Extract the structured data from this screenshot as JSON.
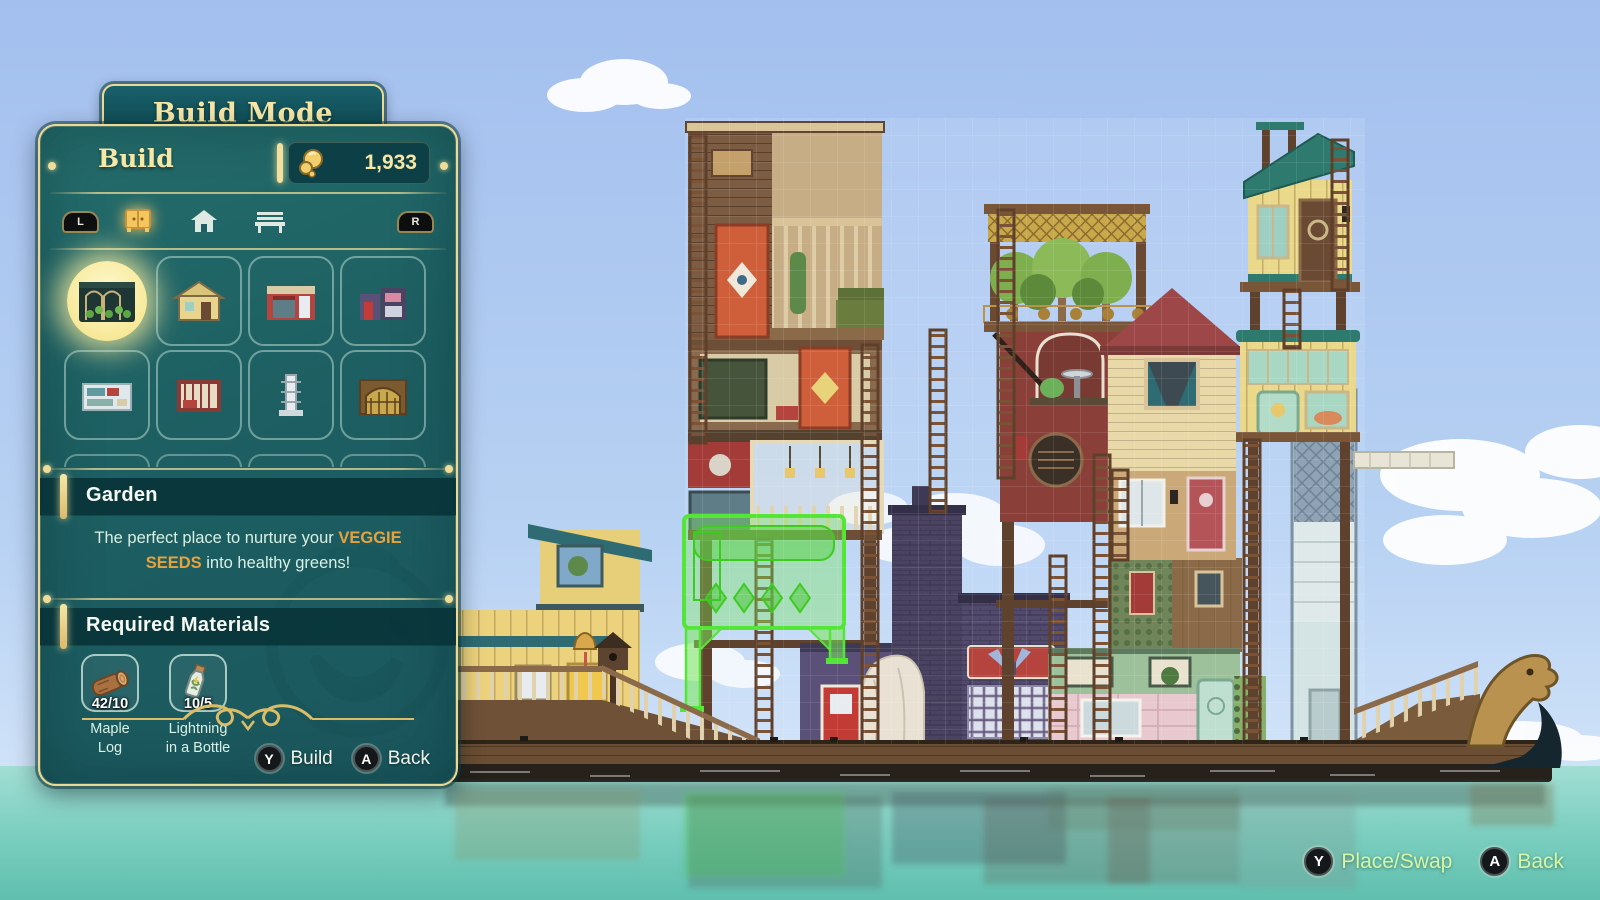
{
  "panel": {
    "title": "Build Mode",
    "header": {
      "label": "Build",
      "currency": "1,933"
    },
    "tabs": {
      "left_bumper": "L",
      "right_bumper": "R",
      "categories": [
        {
          "id": "buildings",
          "icon": "cabinet-icon",
          "selected": true
        },
        {
          "id": "structures",
          "icon": "house-icon",
          "selected": false
        },
        {
          "id": "furniture",
          "icon": "bench-icon",
          "selected": false
        }
      ]
    },
    "grid": {
      "items": [
        {
          "id": "garden",
          "selected": true
        },
        {
          "id": "building-2",
          "selected": false
        },
        {
          "id": "building-3",
          "selected": false
        },
        {
          "id": "building-4",
          "selected": false
        },
        {
          "id": "building-5",
          "selected": false
        },
        {
          "id": "building-6",
          "selected": false
        },
        {
          "id": "building-7",
          "selected": false
        },
        {
          "id": "building-8",
          "selected": false
        }
      ]
    },
    "detail": {
      "name": "Garden",
      "description": {
        "prefix": "The perfect place to nurture your ",
        "highlight": "VEGGIE SEEDS",
        "suffix": " into healthy greens!"
      },
      "materials_title": "Required Materials",
      "materials": [
        {
          "icon": "log-icon",
          "count": "42/10",
          "label_line1": "Maple",
          "label_line2": "Log"
        },
        {
          "icon": "bottle-icon",
          "count": "10/5",
          "label_line1": "Lightning",
          "label_line2": "in a Bottle"
        }
      ]
    },
    "actions": [
      {
        "button": "Y",
        "label": "Build"
      },
      {
        "button": "A",
        "label": "Back"
      }
    ]
  },
  "hud": {
    "actions": [
      {
        "button": "Y",
        "label": "Place/Swap"
      },
      {
        "button": "A",
        "label": "Back"
      }
    ]
  },
  "colors": {
    "gold": "#ecd993",
    "gold_text": "#f6e7a6",
    "panel_teal": "#1d5f62",
    "band_teal": "#08343a",
    "highlight_orange": "#e8a23c",
    "hud_green": "#d6f6a4",
    "ghost_green": "#54e636",
    "sky_blue": "#a9c6f0",
    "water_teal": "#7ccfc0"
  }
}
